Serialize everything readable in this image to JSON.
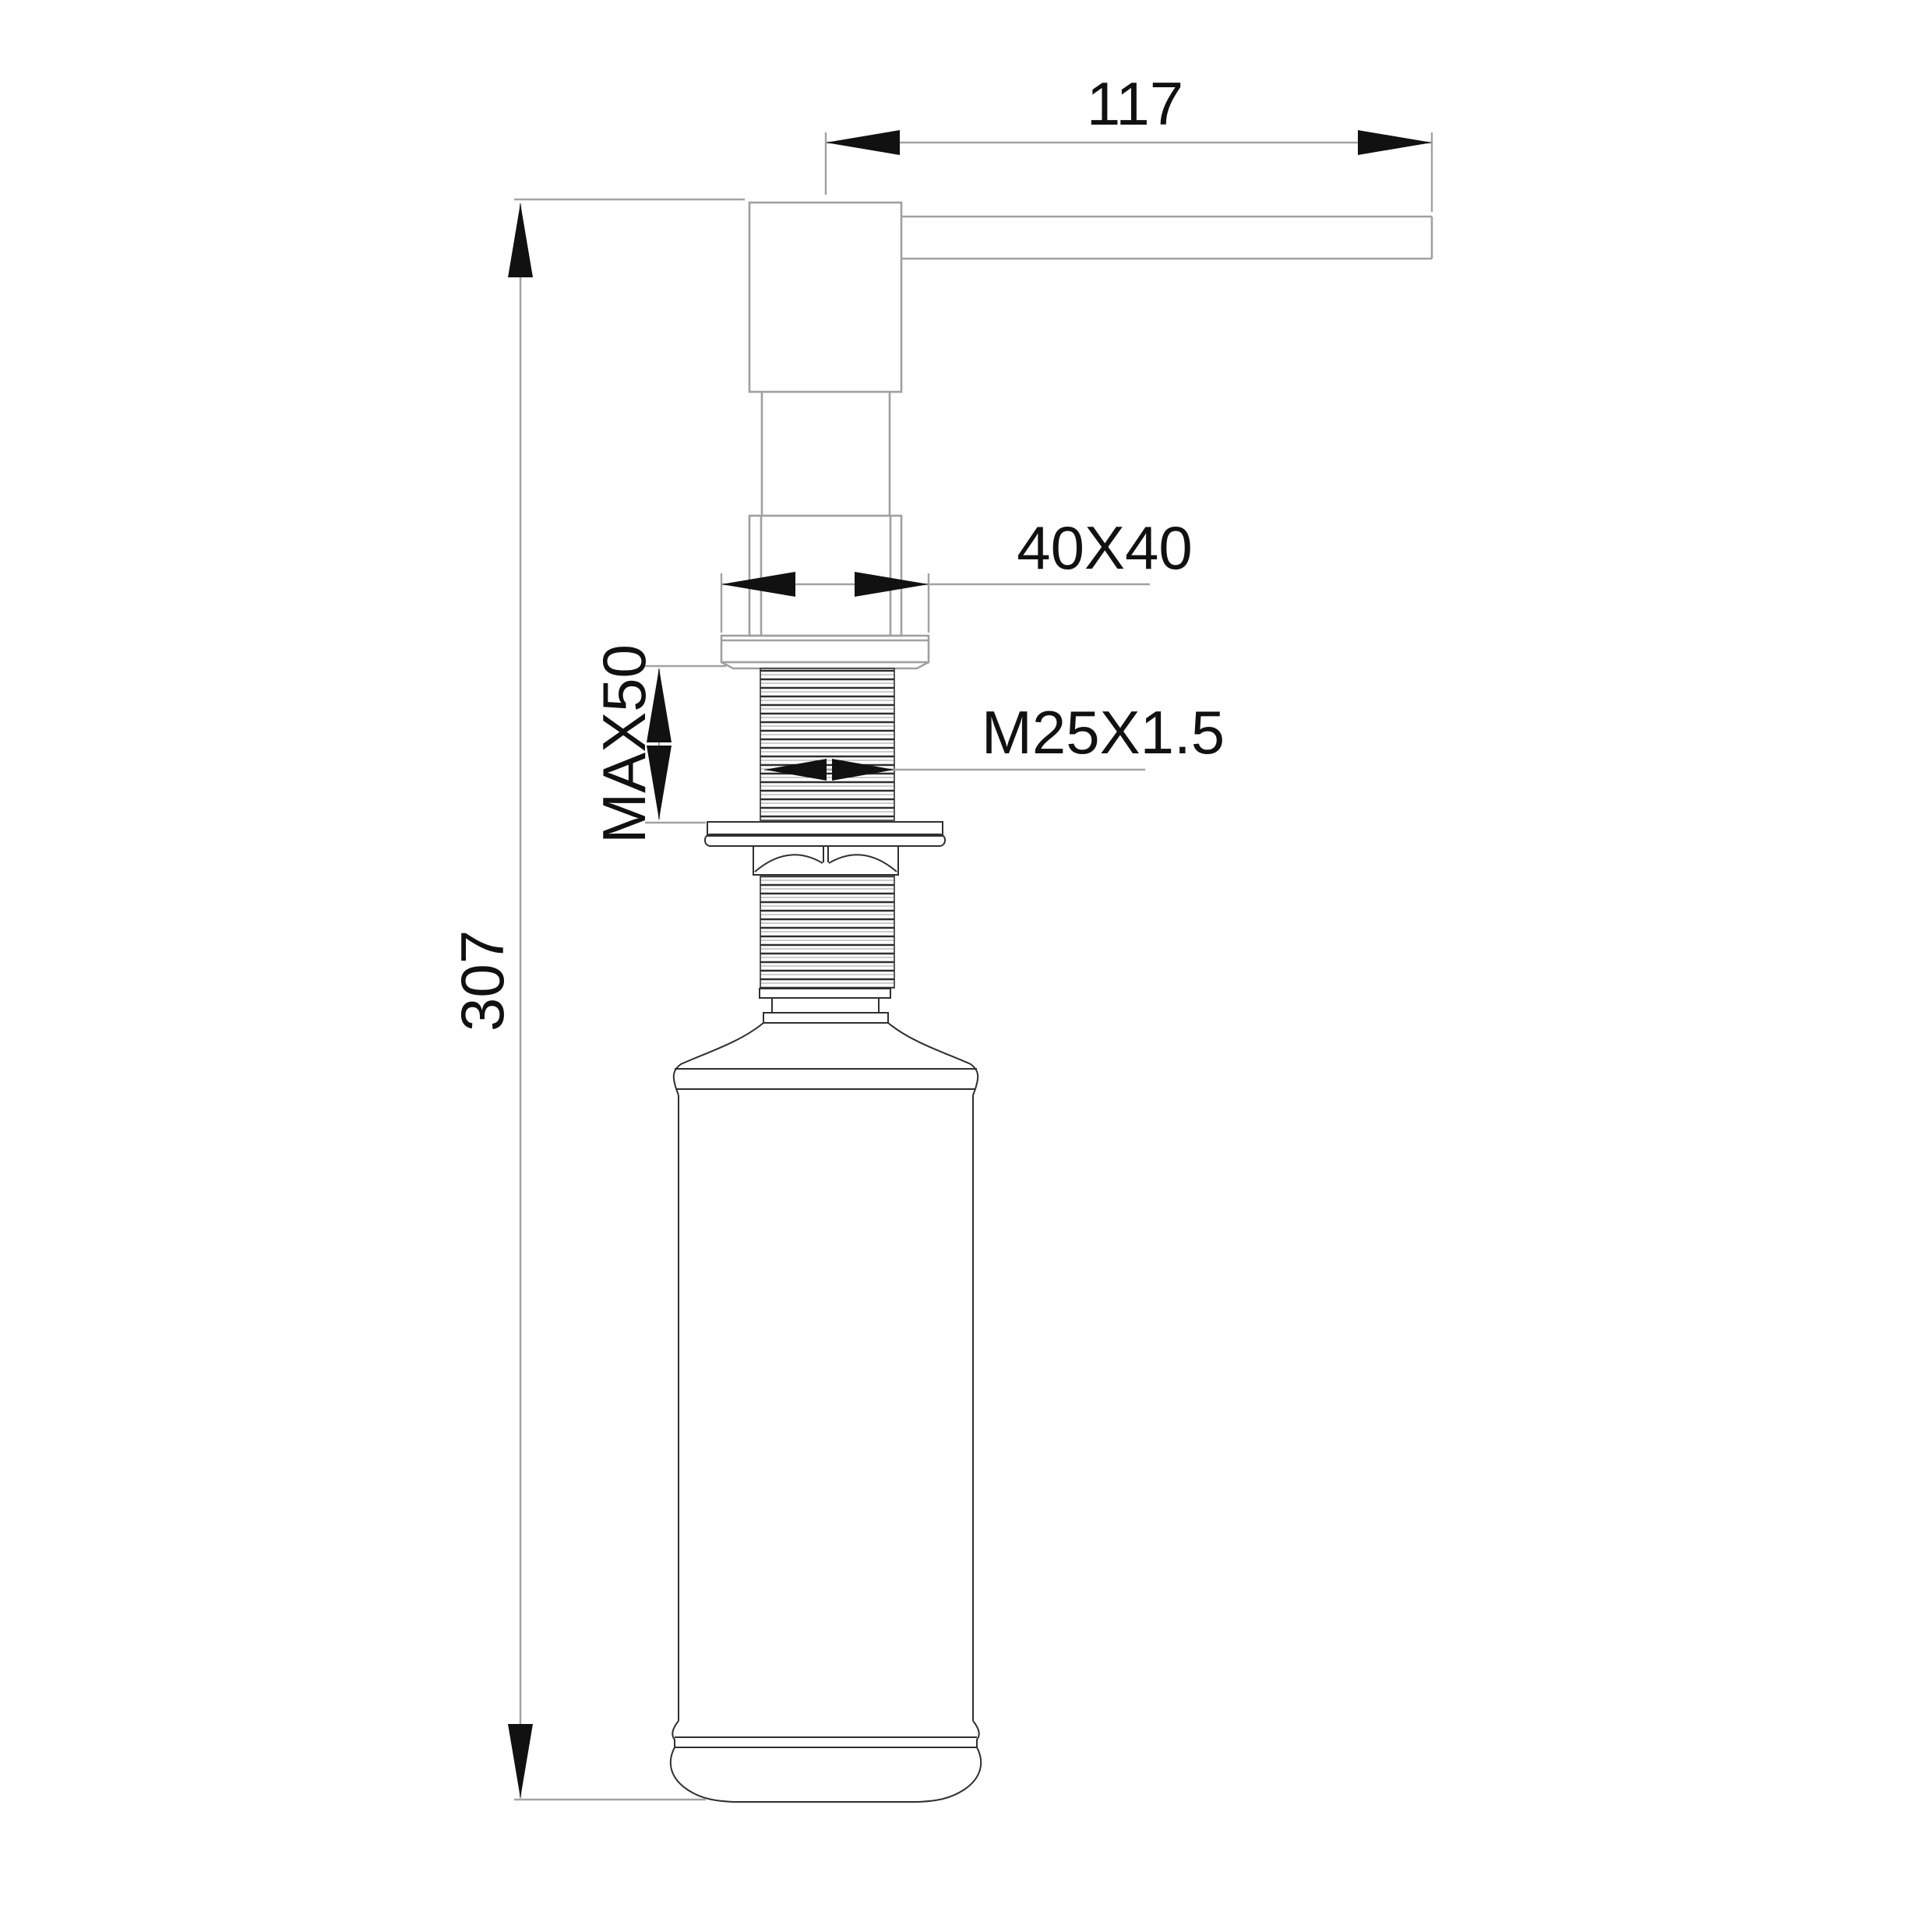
{
  "labels": {
    "spout_reach": "117",
    "head_square": "40X40",
    "max_counter_thickness": "MAX50",
    "thread_spec": "M25X1.5",
    "total_height": "307"
  },
  "colors": {
    "background": "#ffffff",
    "dimension_lines": "#a2a2a2",
    "light_outlines": "#a0a0a0",
    "dark_outlines": "#2f2f2f",
    "text_and_arrows": "#111111"
  }
}
